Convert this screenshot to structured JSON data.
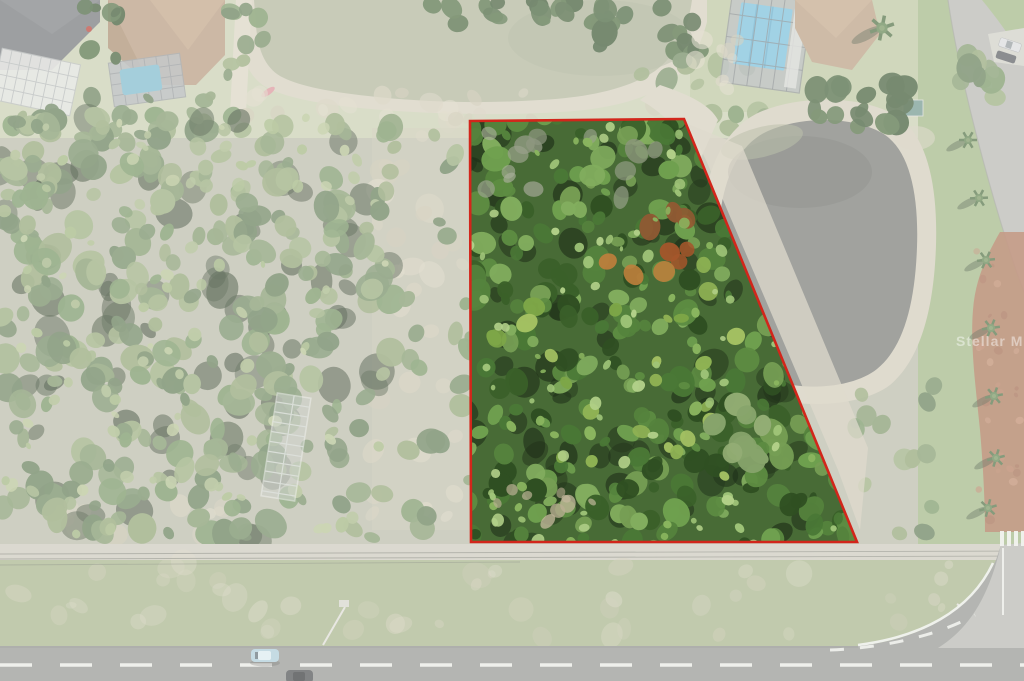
{
  "watermark": {
    "text": "Stellar MLS",
    "color": "#ffffff",
    "opacity": 0.45
  },
  "boundary": {
    "color": "#d2261b",
    "stroke_width": 2.6,
    "vertices": [
      [
        470,
        121
      ],
      [
        684,
        119
      ],
      [
        857,
        542
      ],
      [
        471,
        542
      ]
    ],
    "fade_outside_opacity": 0.33
  },
  "palette": {
    "base": "#b7b8a4",
    "yard": "#c6cdae",
    "yard_right": "#b9c49b",
    "grass_right": "#9db37f",
    "grass_verge": "#a3b185",
    "upper_pond_water": "#adb296",
    "upper_pond_bank": "#d3cdba",
    "lower_pond_water": "#73756f",
    "lower_pond_bank": "#d0c9b6",
    "pool_blue": "#74bcd8",
    "pool_blue_small": "#78b7c9",
    "roof_dark": "#6e7174",
    "roof_tan": "#b49579",
    "lanai_frame": "#a9aeb1",
    "lanai_panel": "#e0e1dd",
    "road_dark": "#8f918c",
    "road_light": "#b3b4ae",
    "sidewalk": "#cac7b9",
    "brick_path": "#a96b4e",
    "sand": "#cfc8b4",
    "lane_marking": "#eceee8",
    "car_blue": "#a9c9d6",
    "car_dark": "#45484a",
    "car_silver": "#d9dadb",
    "teal_shed": "#6a9288",
    "kayak_pink": "#d98f96",
    "structure_frame": "#cdd3cb"
  },
  "forest": {
    "left_colors": [
      "#7b9465",
      "#6a855a",
      "#8ba06e",
      "#5d7850",
      "#93a876",
      "#70905c"
    ],
    "left_light": [
      "#a3b582",
      "#b3c18f",
      "#9cb27a"
    ],
    "property_colors": [
      "#4a7836",
      "#5d8c42",
      "#6fa04f",
      "#3a6029",
      "#82ad5e",
      "#55833d",
      "#2f4f22",
      "#769e54"
    ],
    "property_light": [
      "#9fc478",
      "#b2d089",
      "#8ab55f"
    ],
    "shadow_list": [
      "#26391e",
      "#1f3019"
    ],
    "rust_colors": [
      "#a4562b",
      "#bf7f3c",
      "#8f5a33"
    ],
    "dead_list": [
      "#9aa28c",
      "#8e967f",
      "#a8ae9a"
    ],
    "palm_list": [
      "#8fb254",
      "#a5c263",
      "#7da647"
    ],
    "sage_list": [
      "#87a46b",
      "#93ad74"
    ],
    "dark_greens": [
      "#3e5c33",
      "#49683a",
      "#35512b"
    ],
    "pale_sand": [
      "#cfc8b2",
      "#d8d2bd",
      "#c5bfa6"
    ],
    "clearing_sand": [
      "#b9ae92",
      "#c4b99c"
    ],
    "brick_texture": [
      "#c08a6b",
      "#9a5f44",
      "#b5795b"
    ]
  }
}
